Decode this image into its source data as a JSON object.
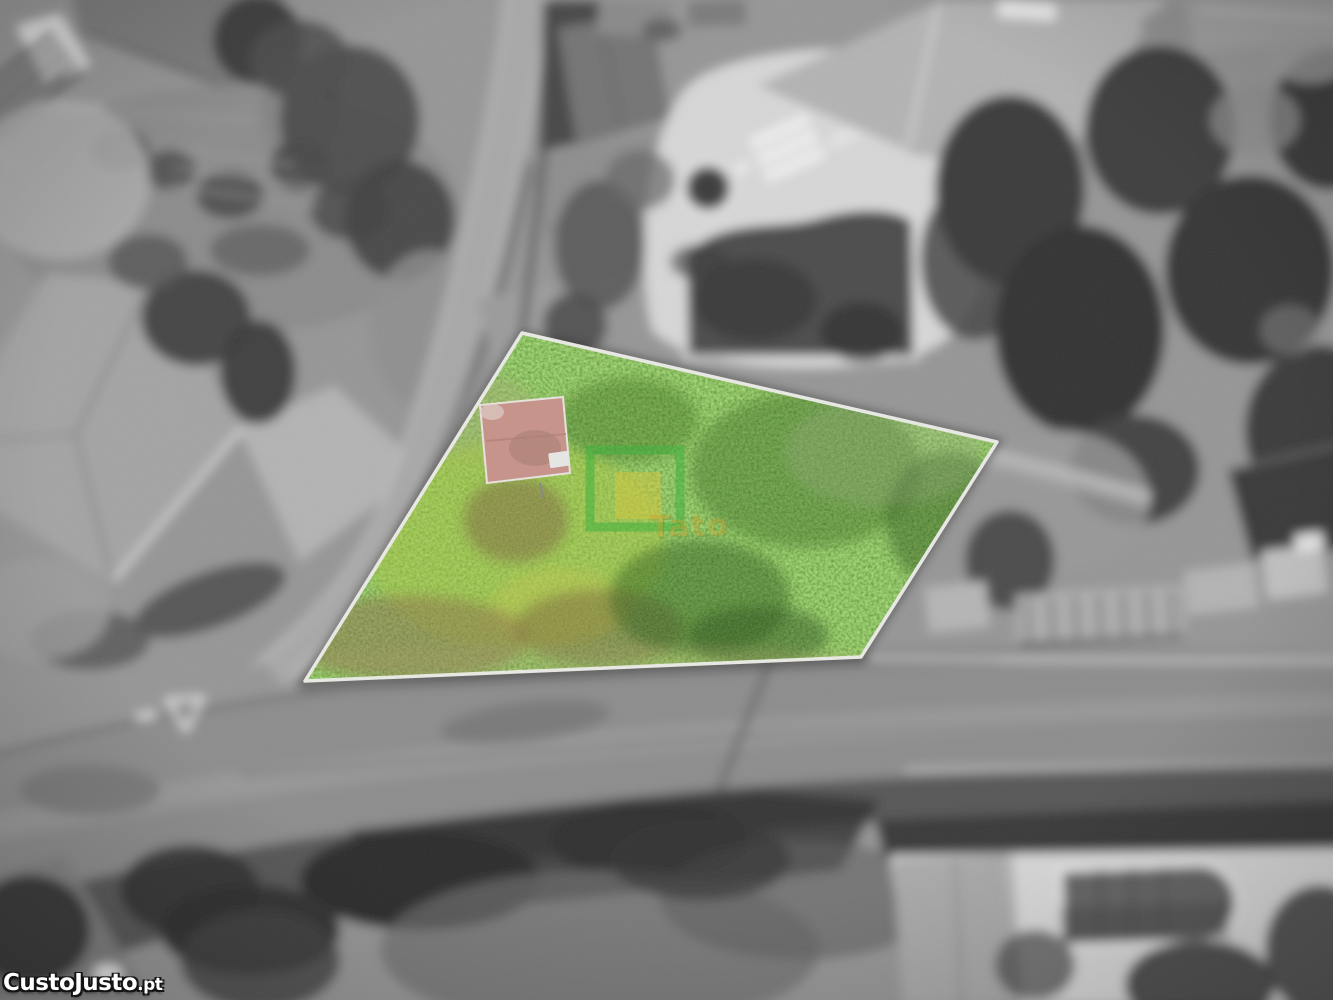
{
  "photo": {
    "kind": "aerial-drone-photograph-with-highlighted-plot",
    "colors": {
      "plot_green": "#5a9a30",
      "plot_border": "#e9e9e4",
      "shed_roof": "#c6938a",
      "logo_green": "#3db23c",
      "logo_yellow": "#d9c53b",
      "logo_text": "#c9a12f",
      "brand_text": "#ffffff",
      "brand_outline": "#141414"
    }
  },
  "watermark": {
    "brand": "CustoJusto",
    "tld": ".pt"
  },
  "agency_logo": {
    "text": "Tato"
  }
}
